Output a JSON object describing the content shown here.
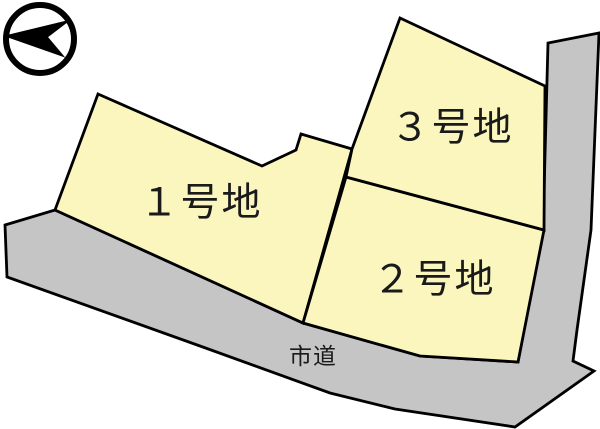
{
  "map": {
    "compass": {
      "icon": "north-arrow-icon"
    },
    "plots": [
      {
        "id": 1,
        "label": "１号地"
      },
      {
        "id": 2,
        "label": "２号地"
      },
      {
        "id": 3,
        "label": "３号地"
      }
    ],
    "road": {
      "label": "市道"
    }
  },
  "colors": {
    "plot_fill": "#FAF6BE",
    "road_fill": "#C5C5C5",
    "outline": "#000000",
    "compass": "#000000",
    "background": "#FFFFFF"
  }
}
